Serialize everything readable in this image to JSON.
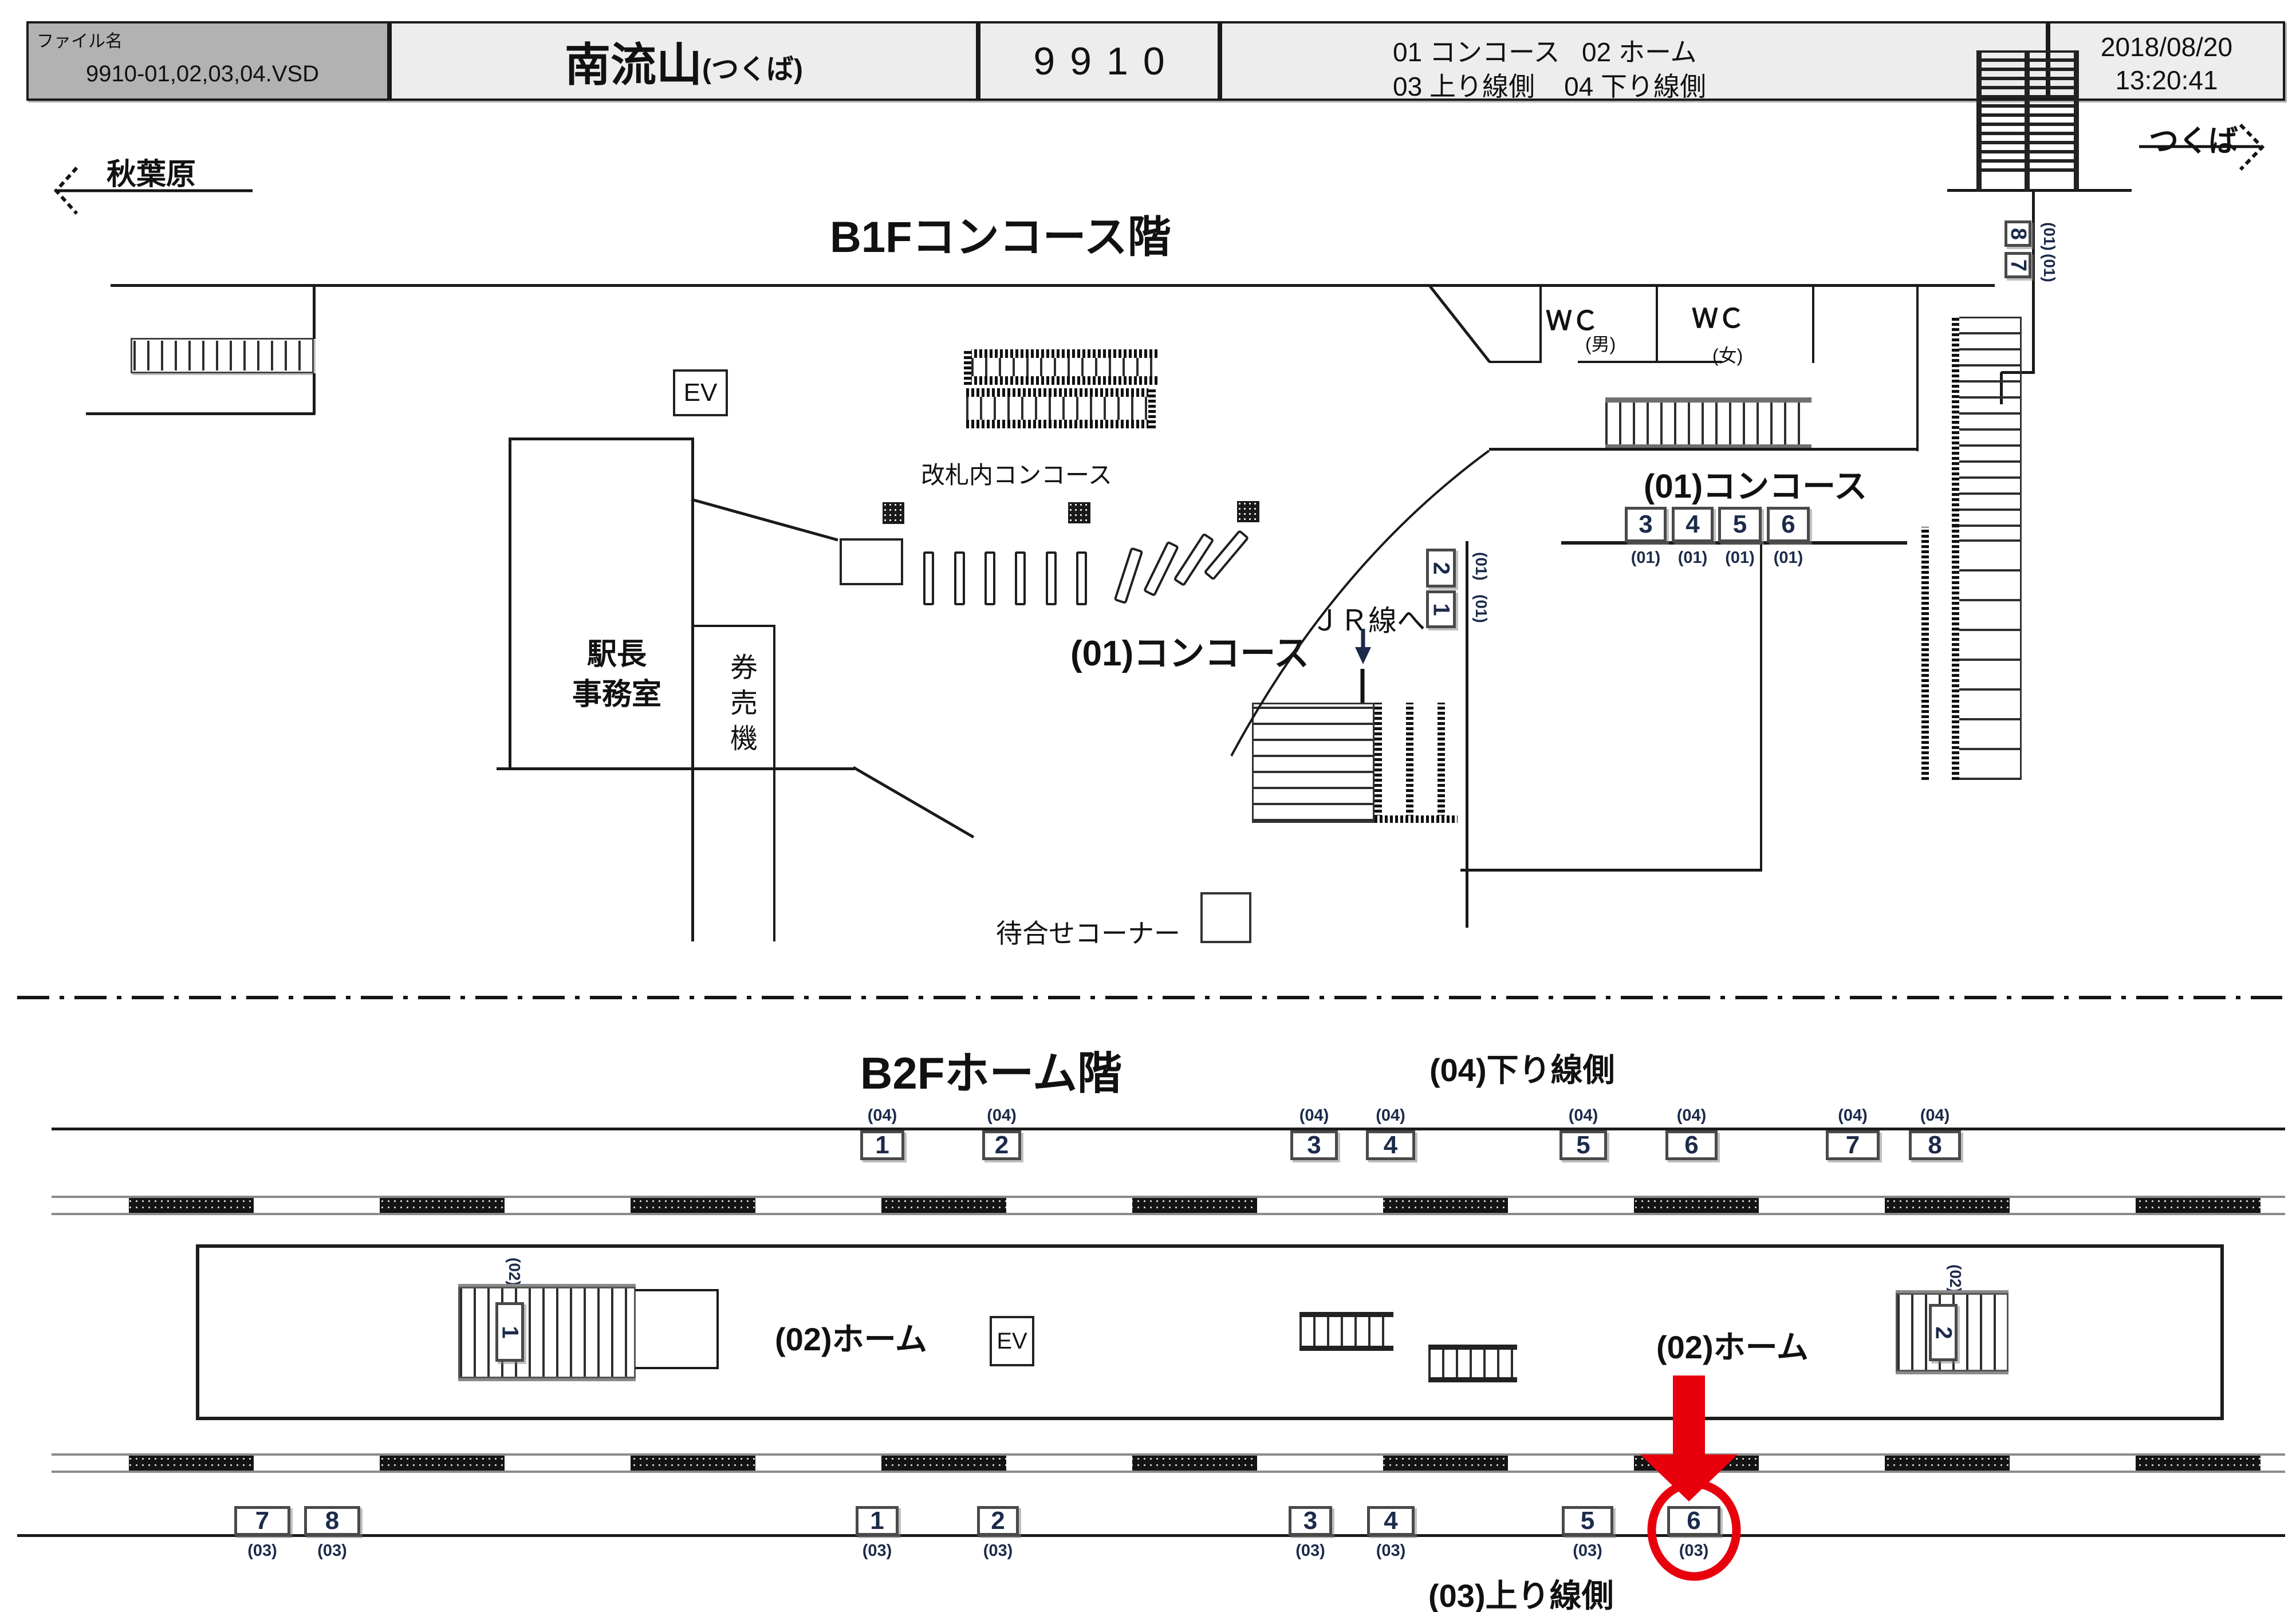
{
  "header": {
    "file_label": "ファイル名",
    "file_value": "9910-01,02,03,04.VSD",
    "station": {
      "main": "南流山",
      "sub": "(つくば)"
    },
    "code": "9910",
    "legend": [
      {
        "code": "01",
        "label": "コンコース"
      },
      {
        "code": "02",
        "label": "ホーム"
      },
      {
        "code": "03",
        "label": "上り線側"
      },
      {
        "code": "04",
        "label": "下り線側"
      }
    ],
    "datetime": {
      "date": "2018/08/20",
      "time": "13:20:41"
    }
  },
  "b1f": {
    "title": "B1Fコンコース階",
    "dir_left": "秋葉原",
    "dir_right": "つくば",
    "labels": {
      "ev": "EV",
      "kaisatsu": "改札内コンコース",
      "concourse_center": "(01)コンコース",
      "concourse_right": "(01)コンコース",
      "stationmaster_1": "駅長",
      "stationmaster_2": "事務室",
      "ticket_machine": "券売機",
      "wc_m": "ＷＣ",
      "wc_m_sub": "(男)",
      "wc_f": "ＷＣ",
      "wc_f_sub": "(女)",
      "jr": "ＪＲ線へ",
      "waiting": "待合せコーナー"
    },
    "right_boxes": [
      {
        "n": "8",
        "cap": "(01)"
      },
      {
        "n": "7",
        "cap": "(01)"
      }
    ],
    "wall_boxes": [
      {
        "n": "3",
        "cap": "(01)"
      },
      {
        "n": "4",
        "cap": "(01)"
      },
      {
        "n": "5",
        "cap": "(01)"
      },
      {
        "n": "6",
        "cap": "(01)"
      }
    ],
    "jr_boxes": [
      {
        "n": "2",
        "cap": "(01)"
      },
      {
        "n": "1",
        "cap": "(01)"
      }
    ]
  },
  "b2f": {
    "title": "B2Fホーム階",
    "down_label": "(04)下り線側",
    "up_label": "(03)上り線側",
    "platform_label_west": "(02)ホーム",
    "platform_label_east": "(02)ホーム",
    "ev": "EV",
    "stair_west": {
      "num": "1",
      "cap": "(02)"
    },
    "stair_east": {
      "num": "2",
      "cap": "(02)"
    },
    "row04": [
      {
        "n": "1",
        "cap": "(04)"
      },
      {
        "n": "2",
        "cap": "(04)"
      },
      {
        "n": "3",
        "cap": "(04)"
      },
      {
        "n": "4",
        "cap": "(04)"
      },
      {
        "n": "5",
        "cap": "(04)"
      },
      {
        "n": "6",
        "cap": "(04)"
      },
      {
        "n": "7",
        "cap": "(04)"
      },
      {
        "n": "8",
        "cap": "(04)"
      }
    ],
    "row03": [
      {
        "n": "7",
        "cap": "(03)"
      },
      {
        "n": "8",
        "cap": "(03)"
      },
      {
        "n": "1",
        "cap": "(03)"
      },
      {
        "n": "2",
        "cap": "(03)"
      },
      {
        "n": "3",
        "cap": "(03)"
      },
      {
        "n": "4",
        "cap": "(03)"
      },
      {
        "n": "5",
        "cap": "(03)"
      },
      {
        "n": "6",
        "cap": "(03)"
      }
    ],
    "highlighted_box": "6"
  },
  "icons": {
    "left_arrow": "left-direction-arrow",
    "right_arrow": "right-direction-arrow",
    "down_arrow": "down-arrow-to-jr",
    "highlight_arrow": "red-highlight-arrow",
    "highlight_circle": "red-highlight-circle"
  },
  "colors": {
    "accent_red": "#e8000d",
    "line": "#1a1a1a",
    "header_fill": "#ededed",
    "header_file_fill": "#b2b2b2",
    "number_text": "#1c2b4a"
  }
}
